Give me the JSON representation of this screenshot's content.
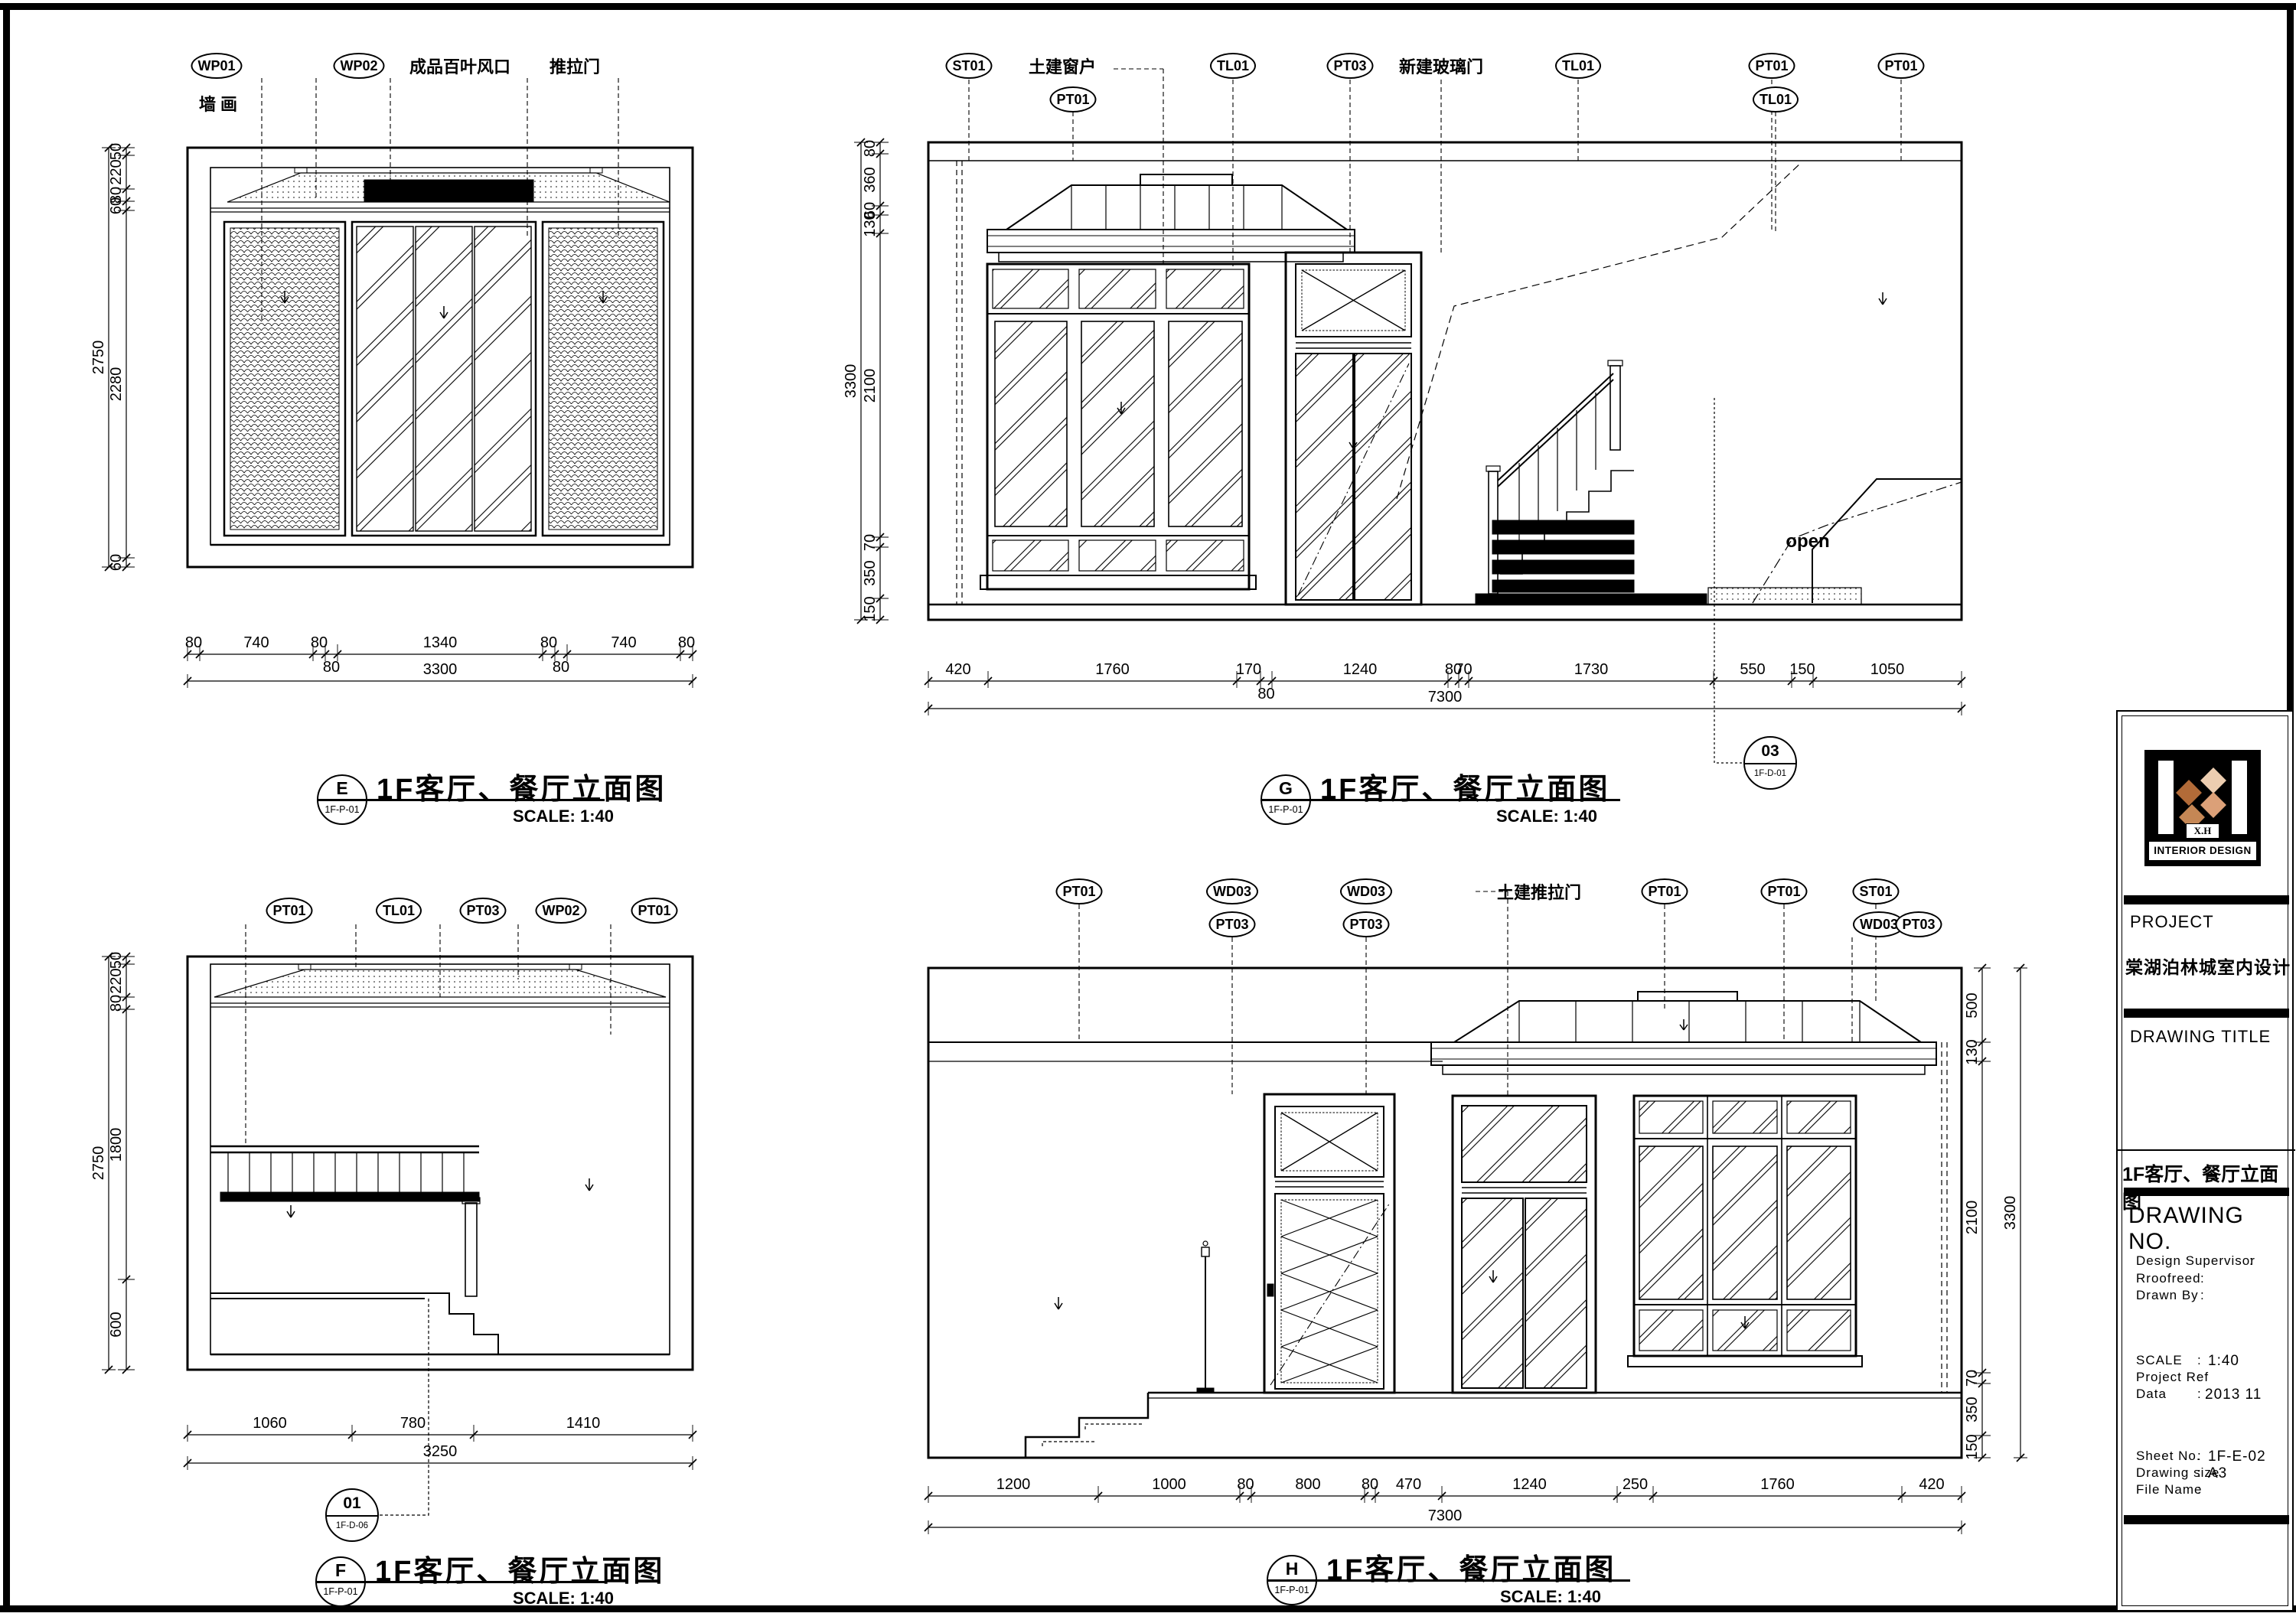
{
  "sheet": {
    "paper_color": "#ffffff",
    "line_color": "#000000",
    "accent_color": "#c58755"
  },
  "drawings": {
    "e": {
      "bubble": {
        "letter": "E",
        "code": "1F-P-01"
      },
      "title": "1F客厅、餐厅立面图",
      "scale": "SCALE: 1:40",
      "callouts": {
        "c1": "WP01",
        "n1": "墙 画",
        "c2": "WP02",
        "n2": "成品百叶风口",
        "n3": "推拉门"
      },
      "dims_left": [
        "50",
        "220",
        "80",
        "60",
        "2280",
        "60"
      ],
      "dims_left_total": "2750",
      "dims_bottom": [
        "80",
        "740",
        "80",
        "80",
        "1340",
        "80",
        "80",
        "740",
        "80"
      ],
      "dims_bottom_total": "3300"
    },
    "g": {
      "bubble": {
        "letter": "G",
        "code": "1F-P-01"
      },
      "title": "1F客厅、餐厅立面图",
      "scale": "SCALE: 1:40",
      "callouts": {
        "c1": "ST01",
        "n1": "土建窗户",
        "c2": "PT01",
        "c3": "TL01",
        "c4": "PT03",
        "n2": "新建玻璃门",
        "c5": "TL01",
        "c6": "PT01",
        "c7": "TL01",
        "c8": "PT01"
      },
      "open_note": "open",
      "detail": {
        "num": "03",
        "code": "1F-D-01"
      },
      "dims_left": [
        "80",
        "360",
        "60",
        "130",
        "2100",
        "70",
        "350",
        "150"
      ],
      "dims_left_total": "3300",
      "dims_bottom": [
        "420",
        "1760",
        "170",
        "80",
        "1240",
        "80",
        "70",
        "1730",
        "550",
        "150",
        "1050"
      ],
      "dims_bottom_total": "7300"
    },
    "f": {
      "bubble": {
        "letter": "F",
        "code": "1F-P-01"
      },
      "title": "1F客厅、餐厅立面图",
      "scale": "SCALE: 1:40",
      "callouts": {
        "c1": "PT01",
        "c2": "TL01",
        "c3": "PT03",
        "c4": "WP02",
        "c5": "PT01"
      },
      "detail": {
        "num": "01",
        "code": "1F-D-06"
      },
      "dims_left": [
        "50",
        "220",
        "80",
        "1800",
        "600"
      ],
      "dims_left_total": "2750",
      "dims_bottom": [
        "1060",
        "780",
        "1410"
      ],
      "dims_bottom_total": "3250"
    },
    "h": {
      "bubble": {
        "letter": "H",
        "code": "1F-P-01"
      },
      "title": "1F客厅、餐厅立面图",
      "scale": "SCALE: 1:40",
      "callouts": {
        "c1": "PT01",
        "c2": "WD03",
        "c3": "PT03",
        "c4": "WD03",
        "c5": "PT03",
        "n1": "土建推拉门",
        "c6": "PT01",
        "c7": "PT01",
        "c8": "ST01",
        "c9": "WD03",
        "c10": "PT03"
      },
      "dims_right": [
        "500",
        "130",
        "2100",
        "70",
        "350",
        "150"
      ],
      "dims_right_total": "3300",
      "dims_bottom": [
        "1200",
        "1000",
        "80",
        "800",
        "80",
        "470",
        "1240",
        "250",
        "1760",
        "420"
      ],
      "dims_bottom_total": "7300"
    }
  },
  "titleblock": {
    "logo": {
      "monogram": "X.H",
      "caption": "INTERIOR DESIGN"
    },
    "project_label": "PROJECT",
    "project_name": "棠湖泊林城室内设计",
    "drawing_title_label": "DRAWING TITLE",
    "drawing_title_cn": "1F客厅、餐厅立面图",
    "drawing_no_label": "DRAWING NO.",
    "rows": [
      {
        "label": "Design Supervisor",
        "sep": ":",
        "value": ""
      },
      {
        "label": "Rroofreed",
        "sep": ":",
        "value": ""
      },
      {
        "label": "Drawn By",
        "sep": ":",
        "value": ""
      },
      {
        "label": "SCALE",
        "sep": ":",
        "value": "1:40"
      },
      {
        "label": "Project Ref",
        "sep": ":",
        "value": ""
      },
      {
        "label": "Data",
        "sep": ":",
        "value": "2013 11"
      },
      {
        "label": "Sheet No.",
        "sep": ":",
        "value": "1F-E-02"
      },
      {
        "label": "Drawing size",
        "sep": ":",
        "value": "A3"
      },
      {
        "label": "File Name",
        "sep": ":",
        "value": ""
      }
    ]
  }
}
